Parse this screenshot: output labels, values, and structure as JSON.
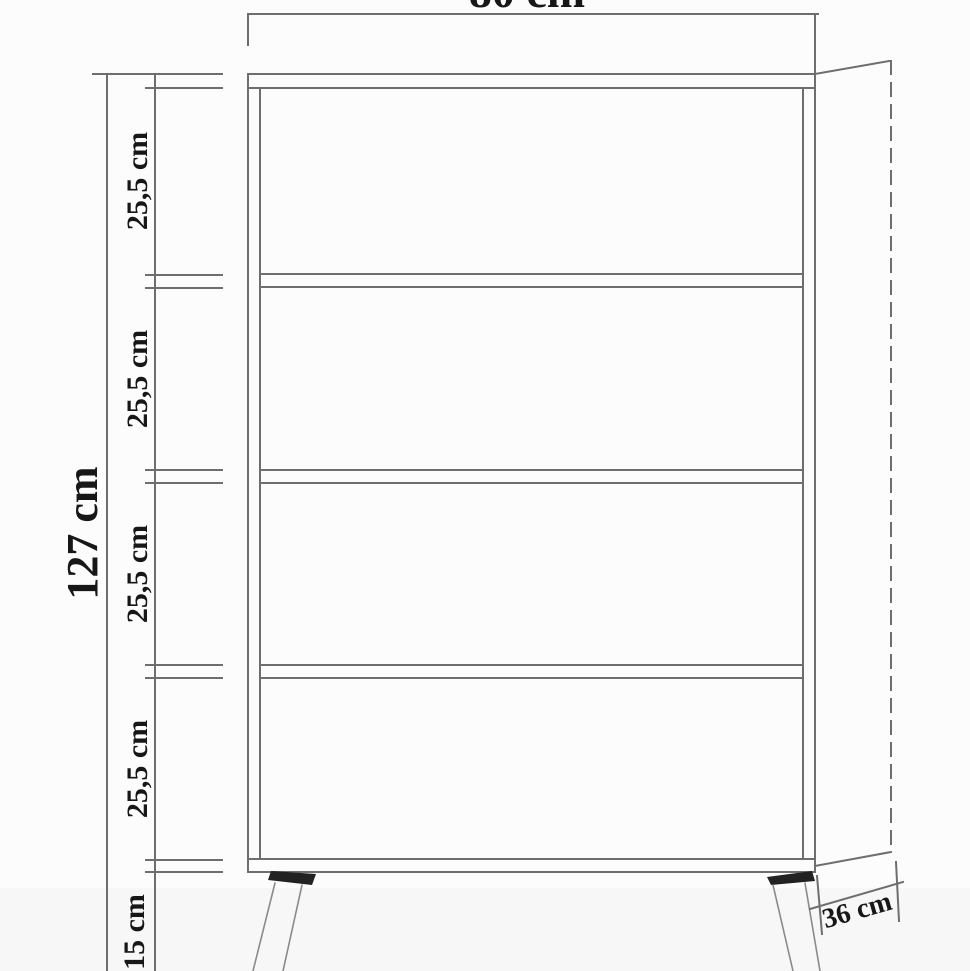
{
  "page": {
    "background": "#fcfcfc",
    "floor_tint": "#f3f3f2"
  },
  "drawing": {
    "type": "furniture-dimension-diagram",
    "subject": "open bookcase with four shelf compartments on splayed legs, front view with depth perspective",
    "colors": {
      "line": "#6e6e6e",
      "leg_line": "#8a8a8a",
      "text": "#171717",
      "leg_fill": "#222222"
    },
    "dimensions": {
      "width": {
        "label": "80 cm"
      },
      "height": {
        "label": "127 cm"
      },
      "depth": {
        "label": "36 cm"
      },
      "sections": [
        {
          "label": "25,5 cm"
        },
        {
          "label": "25,5 cm"
        },
        {
          "label": "25,5 cm"
        },
        {
          "label": "25,5 cm"
        }
      ],
      "base_height": {
        "label": "15 cm"
      }
    }
  }
}
